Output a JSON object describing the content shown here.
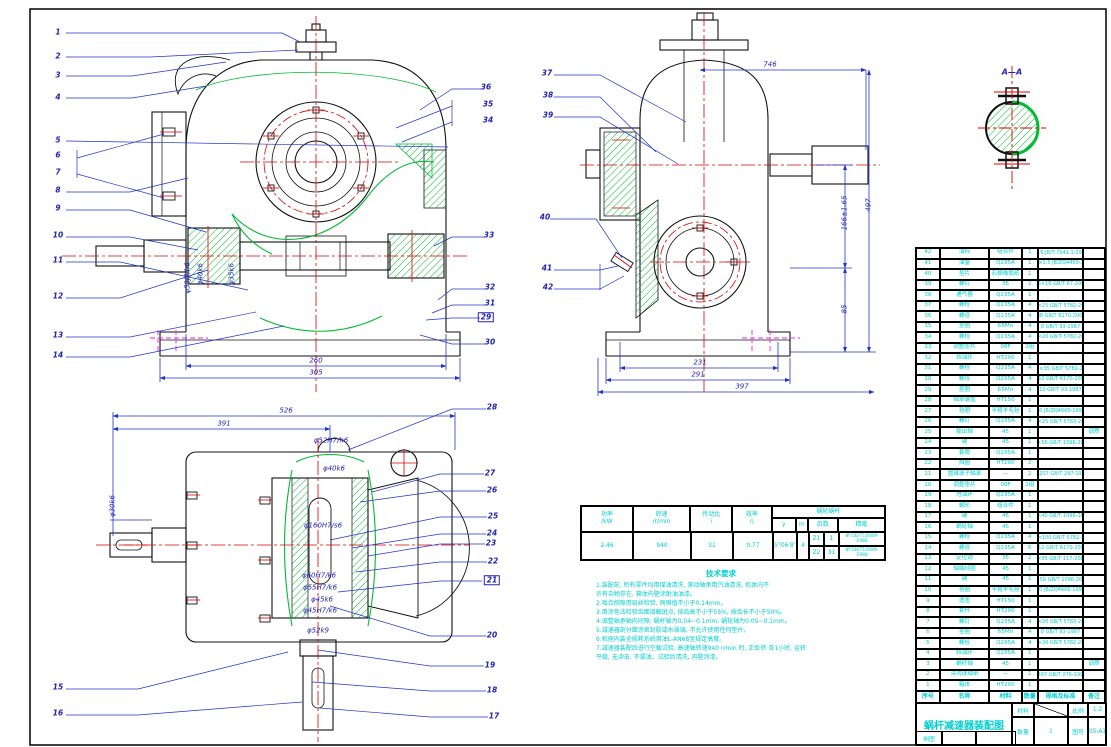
{
  "drawing": {
    "detail_label": "A—A",
    "colors": {
      "outline": "#111111",
      "centerline": "#dd0000",
      "dimension": "#2233cc",
      "hatch": "#00bb33",
      "table_text": "#00cfcf",
      "phantom": "#ee22ee"
    }
  },
  "callouts": [
    {
      "n": "1",
      "x": 58,
      "y": 32
    },
    {
      "n": "2",
      "x": 58,
      "y": 56
    },
    {
      "n": "3",
      "x": 58,
      "y": 75
    },
    {
      "n": "4",
      "x": 58,
      "y": 97
    },
    {
      "n": "5",
      "x": 58,
      "y": 140
    },
    {
      "n": "6",
      "x": 58,
      "y": 155
    },
    {
      "n": "7",
      "x": 58,
      "y": 172
    },
    {
      "n": "8",
      "x": 58,
      "y": 190
    },
    {
      "n": "9",
      "x": 58,
      "y": 208
    },
    {
      "n": "10",
      "x": 58,
      "y": 235
    },
    {
      "n": "11",
      "x": 58,
      "y": 260
    },
    {
      "n": "12",
      "x": 58,
      "y": 296
    },
    {
      "n": "13",
      "x": 58,
      "y": 335
    },
    {
      "n": "14",
      "x": 58,
      "y": 355
    },
    {
      "n": "15",
      "x": 58,
      "y": 687
    },
    {
      "n": "16",
      "x": 58,
      "y": 713
    },
    {
      "n": "36",
      "x": 486,
      "y": 87
    },
    {
      "n": "35",
      "x": 488,
      "y": 104
    },
    {
      "n": "34",
      "x": 488,
      "y": 120
    },
    {
      "n": "33",
      "x": 489,
      "y": 235
    },
    {
      "n": "32",
      "x": 490,
      "y": 287
    },
    {
      "n": "31",
      "x": 490,
      "y": 303
    },
    {
      "n": "29",
      "x": 486,
      "y": 317,
      "boxed": true
    },
    {
      "n": "30",
      "x": 490,
      "y": 342
    },
    {
      "n": "37",
      "x": 547,
      "y": 73
    },
    {
      "n": "38",
      "x": 548,
      "y": 95
    },
    {
      "n": "39",
      "x": 548,
      "y": 115
    },
    {
      "n": "40",
      "x": 545,
      "y": 217
    },
    {
      "n": "41",
      "x": 547,
      "y": 268
    },
    {
      "n": "42",
      "x": 548,
      "y": 287
    },
    {
      "n": "28",
      "x": 492,
      "y": 407
    },
    {
      "n": "27",
      "x": 490,
      "y": 473
    },
    {
      "n": "26",
      "x": 492,
      "y": 490
    },
    {
      "n": "25",
      "x": 493,
      "y": 516
    },
    {
      "n": "24",
      "x": 492,
      "y": 533
    },
    {
      "n": "23",
      "x": 491,
      "y": 543
    },
    {
      "n": "22",
      "x": 493,
      "y": 561
    },
    {
      "n": "21",
      "x": 492,
      "y": 580,
      "boxed": true
    },
    {
      "n": "20",
      "x": 492,
      "y": 635
    },
    {
      "n": "19",
      "x": 490,
      "y": 665
    },
    {
      "n": "18",
      "x": 492,
      "y": 690
    },
    {
      "n": "17",
      "x": 494,
      "y": 716
    }
  ],
  "dimensions": [
    {
      "text": "260",
      "x": 316,
      "y": 361
    },
    {
      "text": "305",
      "x": 316,
      "y": 373
    },
    {
      "text": "746",
      "x": 770,
      "y": 65
    },
    {
      "text": "166±1.65",
      "x": 845,
      "y": 213,
      "rot": true
    },
    {
      "text": "85",
      "x": 845,
      "y": 309,
      "rot": true
    },
    {
      "text": "497",
      "x": 869,
      "y": 205,
      "rot": true
    },
    {
      "text": "231",
      "x": 700,
      "y": 363
    },
    {
      "text": "291",
      "x": 698,
      "y": 375
    },
    {
      "text": "397",
      "x": 742,
      "y": 387
    },
    {
      "text": "526",
      "x": 286,
      "y": 411
    },
    {
      "text": "391",
      "x": 224,
      "y": 424
    }
  ],
  "fit_labels": [
    {
      "text": "φ52J7/h6",
      "x": 188,
      "y": 278,
      "rot": true
    },
    {
      "text": "φ40k6",
      "x": 201,
      "y": 274,
      "rot": true
    },
    {
      "text": "φ35k6",
      "x": 232,
      "y": 274,
      "rot": true
    },
    {
      "text": "φ30k6",
      "x": 113,
      "y": 506,
      "rot": true
    },
    {
      "text": "φ52H7/h6",
      "x": 331,
      "y": 441
    },
    {
      "text": "φ40k6",
      "x": 334,
      "y": 469
    },
    {
      "text": "φ160H7/s6",
      "x": 323,
      "y": 526
    },
    {
      "text": "φ60H7/k6",
      "x": 319,
      "y": 576
    },
    {
      "text": "φ55H7/k6",
      "x": 320,
      "y": 588
    },
    {
      "text": "φ45k6",
      "x": 322,
      "y": 600
    },
    {
      "text": "φ45H7/k6",
      "x": 320,
      "y": 611
    },
    {
      "text": "φ52k9",
      "x": 318,
      "y": 631
    }
  ],
  "param_table": {
    "headers": {
      "power": [
        "功率",
        "/kW"
      ],
      "speed": [
        "转速",
        "/r/min"
      ],
      "ratio": [
        "传动比",
        "i"
      ],
      "eff": [
        "效率",
        "η"
      ],
      "pair": "蜗轮蜗杆",
      "gamma": "γ",
      "module": "m",
      "teeth": "齿数",
      "precision": "精度"
    },
    "values": {
      "power": "2.46",
      "speed": "940",
      "ratio": "31",
      "eff": "0.77",
      "gamma": "5°06′8″",
      "module": "4",
      "z1_label": "Z1",
      "z1": "1",
      "z2_label": "Z2",
      "z2": "31",
      "precision1": "8f GB/T10089-1988",
      "precision2": "8f GB/T10089-1988"
    }
  },
  "notes": {
    "title": "技术要求",
    "lines": [
      "1.装配前, 所有零件均用煤油清洗, 滚动轴承用汽油清洗, 机体内不",
      "  许有杂物存在, 箱体内壁涂耐油油漆。",
      "2.啮合侧隙用铅丝检验, 侧隙值不小于0.14mm。",
      "3.用涂色法检验齿面接触斑点, 按齿高不小于55%, 按齿长不小于50%。",
      "4.调整轴承轴向间隙: 蜗杆轴为0.04~0.1mm, 蜗轮轴为0.05~0.1mm。",
      "5.减速器剖分面涂密封胶或水玻璃, 不允许使用任何垫片。",
      "6.机座内装全损耗系统用油L-AN68至规定高度。",
      "7.减速器装配后进行空载试验, 高速轴转速940 r/min 时, 正反转 各1小时, 运转",
      "  平稳, 无冲击, 不漏油。试验后清洗, 内壁涂漆。"
    ]
  },
  "bom": {
    "headers": [
      "序号",
      "名称",
      "材料",
      "数量",
      "规格及标准",
      "备注"
    ],
    "rows": [
      [
        "42",
        "油标",
        "组合件",
        "1",
        "M16 JB/T 7941.1-1995",
        ""
      ],
      [
        "41",
        "油塞",
        "Q235A",
        "1",
        "M16×1.5 JB/ZQ4450-1997",
        ""
      ],
      [
        "40",
        "垫片",
        "石棉橡胶纸",
        "1",
        "",
        ""
      ],
      [
        "39",
        "螺钉",
        "35",
        "2",
        "M6×16 GB/T 67-2008",
        ""
      ],
      [
        "38",
        "通气器",
        "Q235A",
        "1",
        "",
        ""
      ],
      [
        "37",
        "螺栓",
        "Q235A",
        "4",
        "M8×25 GB/T 5782-2000",
        ""
      ],
      [
        "36",
        "螺母",
        "Q235A",
        "4",
        "M8 GB/T 6170-2000",
        ""
      ],
      [
        "35",
        "垫圈",
        "65Mn",
        "4",
        "8 GB/T 93-1987",
        ""
      ],
      [
        "34",
        "螺栓",
        "Q235A",
        "4",
        "M8×20 GB/T 5782-2000",
        ""
      ],
      [
        "33",
        "调整垫片",
        "08F",
        "2组",
        "",
        ""
      ],
      [
        "32",
        "挡油环",
        "HT200",
        "1",
        "",
        ""
      ],
      [
        "31",
        "螺栓",
        "Q235A",
        "4",
        "M10×35 GB/T 5782-2000",
        ""
      ],
      [
        "30",
        "螺母",
        "Q235A",
        "4",
        "M10 GB/T 6170-2000",
        ""
      ],
      [
        "29",
        "垫圈",
        "65Mn",
        "4",
        "10 GB/T 93-1987",
        ""
      ],
      [
        "28",
        "轴承端盖",
        "HT150",
        "1",
        "",
        ""
      ],
      [
        "27",
        "毡圈",
        "半粗羊毛毡",
        "1",
        "40 JB/ZQ4606-1997",
        ""
      ],
      [
        "26",
        "螺钉",
        "Q235A",
        "4",
        "M8×25 GB/T 5783-2000",
        ""
      ],
      [
        "25",
        "输出轴",
        "45",
        "1",
        "",
        "调质"
      ],
      [
        "24",
        "键",
        "45",
        "1",
        "12×56 GB/T 1096-2003",
        ""
      ],
      [
        "23",
        "套筒",
        "Q235A",
        "1",
        "",
        ""
      ],
      [
        "22",
        "挡圈",
        "HT200",
        "2",
        "",
        ""
      ],
      [
        "21",
        "圆锥滚子轴承",
        "—",
        "2",
        "30207 GB/T 297-1994",
        ""
      ],
      [
        "20",
        "调整垫片",
        "08F",
        "2组",
        "",
        ""
      ],
      [
        "19",
        "甩油环",
        "Q235A",
        "1",
        "",
        ""
      ],
      [
        "18",
        "蜗轮",
        "组合件",
        "1",
        "",
        ""
      ],
      [
        "17",
        "键",
        "45",
        "1",
        "10×40 GB/T 1096-2003",
        ""
      ],
      [
        "16",
        "蜗轮轴",
        "45",
        "1",
        "",
        ""
      ],
      [
        "15",
        "螺栓",
        "Q235A",
        "4",
        "M12×100 GB/T 5782-2000",
        ""
      ],
      [
        "14",
        "螺母",
        "Q235A",
        "6",
        "M12 GB/T 6170-2000",
        ""
      ],
      [
        "13",
        "定位销",
        "35",
        "2",
        "8×35 GB/T 117-2000",
        ""
      ],
      [
        "12",
        "轴端挡圈",
        "45",
        "1",
        "",
        ""
      ],
      [
        "11",
        "键",
        "45",
        "1",
        "8×50 GB/T 1096-2003",
        ""
      ],
      [
        "10",
        "毡圈",
        "半粗羊毛毡",
        "1",
        "30 JB/ZQ4606-1997",
        ""
      ],
      [
        "9",
        "透盖",
        "HT150",
        "1",
        "",
        ""
      ],
      [
        "8",
        "套杯",
        "HT200",
        "1",
        "",
        ""
      ],
      [
        "7",
        "螺钉",
        "Q235A",
        "4",
        "M8×20 GB/T 5783-2000",
        ""
      ],
      [
        "6",
        "垫圈",
        "65Mn",
        "4",
        "8 GB/T 93-1987",
        ""
      ],
      [
        "5",
        "螺栓",
        "Q235A",
        "4",
        "M8×30 GB/T 5782-2000",
        ""
      ],
      [
        "4",
        "挡油环",
        "Q235A",
        "1",
        "",
        ""
      ],
      [
        "3",
        "蜗杆轴",
        "45",
        "1",
        "",
        "调质"
      ],
      [
        "2",
        "深沟球轴承",
        "—",
        "1",
        "6207 GB/T 276-1994",
        ""
      ],
      [
        "1",
        "箱体",
        "HT200",
        "1",
        "",
        ""
      ]
    ]
  },
  "title_block": {
    "title": "蜗杆减速器装配图",
    "material_label": "材料",
    "scale_label": "比例",
    "scale_value": "1:2",
    "qty_label": "数量",
    "qty_value": "1",
    "no_label": "图号",
    "no_value": "05-A1",
    "draft_label": "制图"
  }
}
